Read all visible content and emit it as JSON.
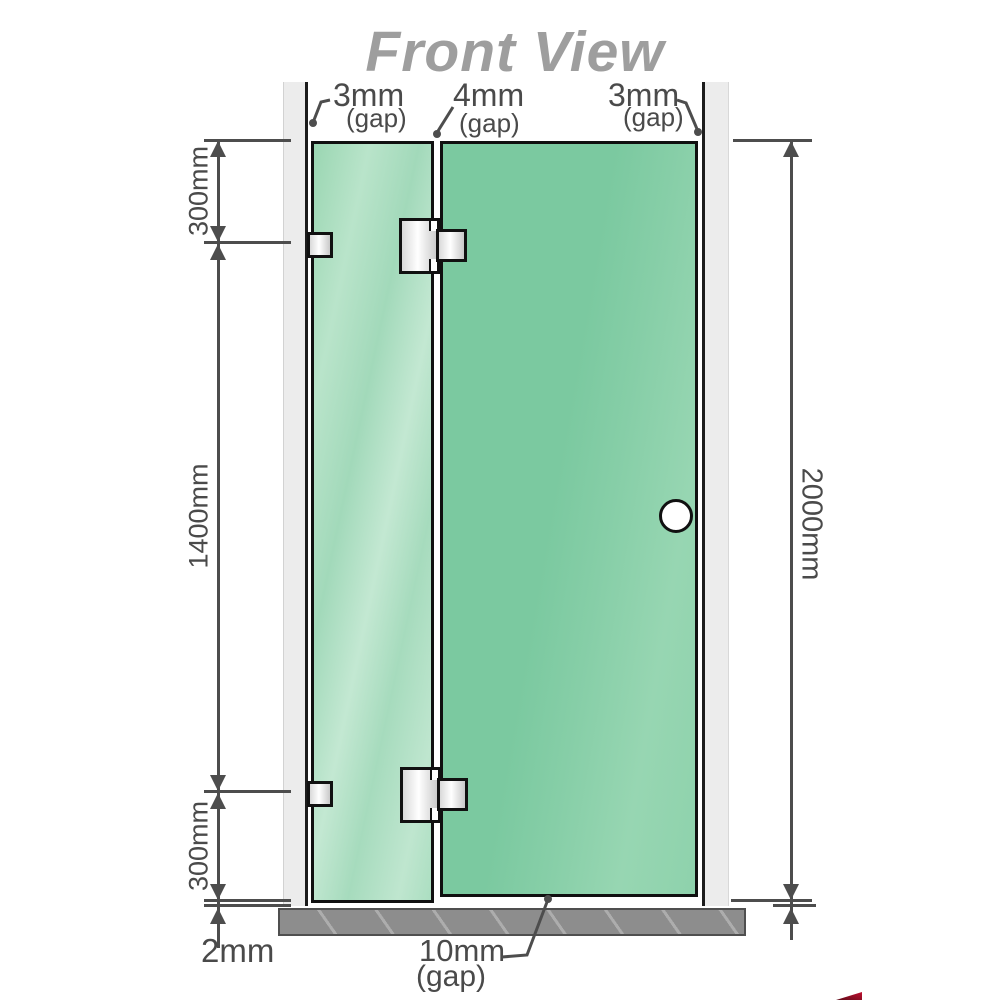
{
  "title": "Front View",
  "annotations": {
    "top_gaps": [
      {
        "value": "3mm",
        "note": "(gap)"
      },
      {
        "value": "4mm",
        "note": "(gap)"
      },
      {
        "value": "3mm",
        "note": "(gap)"
      }
    ],
    "left_dims": {
      "top": "300mm",
      "middle": "1400mm",
      "bottom": "300mm",
      "floor_gap": "2mm"
    },
    "right_dim": "2000mm",
    "bottom_gap": {
      "value": "10mm",
      "note": "(gap)"
    }
  },
  "colors": {
    "glass_green": "#7bc9a0",
    "glass_green_light": "#b9e4ca",
    "wall_gray": "#ececec",
    "base_gray": "#8d8d8d",
    "dim_line_gray": "#4d4d4d",
    "title_gray": "#9e9e9e",
    "hardware_outline": "#111111",
    "watermark_red": "#c01030"
  }
}
